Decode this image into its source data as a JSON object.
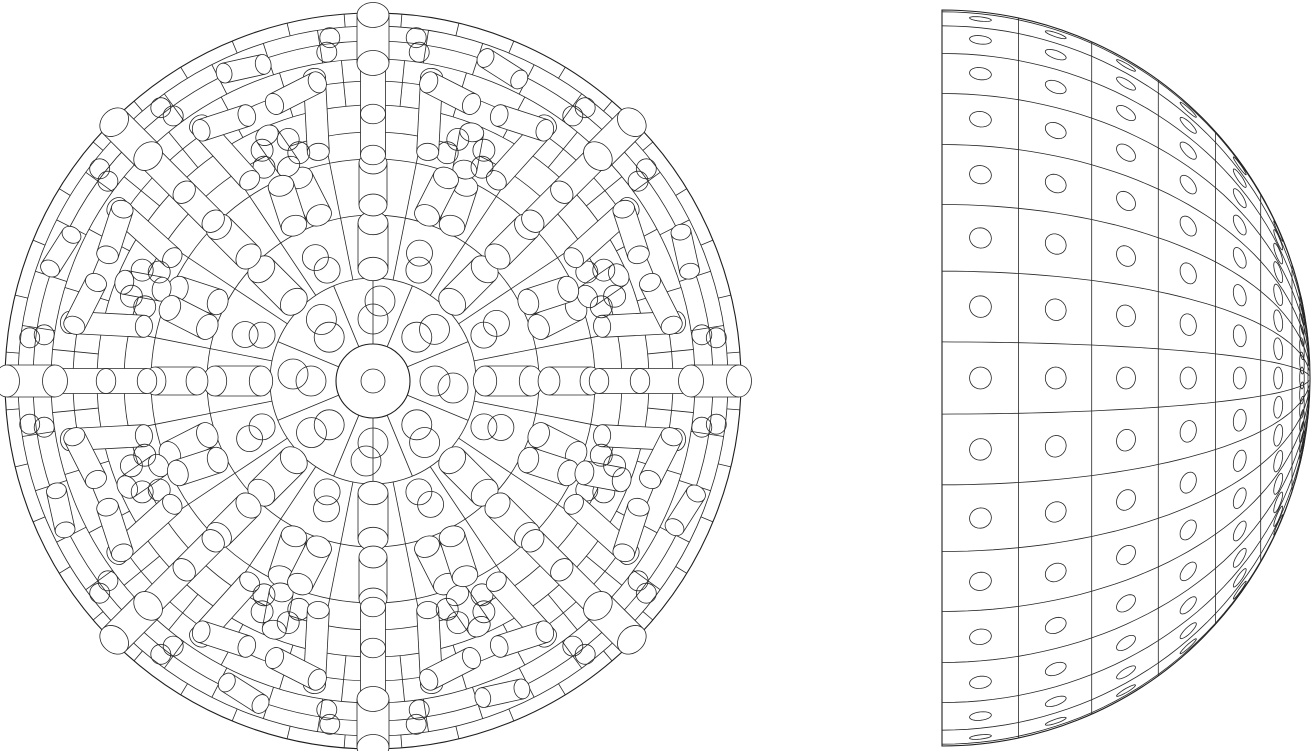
{
  "page": {
    "background_color": "#ffffff",
    "width": 1313,
    "height": 751,
    "title": "Perforated dome two-view technical drawing"
  },
  "drawing": {
    "type": "cad_wireframe",
    "description": "Black-on-white line drawing, two orthographic views of a hemispherical dome assembly: left plan view of concentric panel rings with cylindrical pegs, right side elevation with grid panels each pierced by a round hole",
    "stroke_color": "#262626",
    "stroke_color_outline": "#1f1f1f",
    "stroke_width_detail": 0.8,
    "stroke_width_outline": 1.1,
    "plan_view": {
      "center": [
        373,
        381
      ],
      "outer_radius": 368,
      "hub_hole_radius": 12,
      "hub_disc_radius": 37,
      "ring_circles": [
        12,
        37,
        103,
        166,
        222,
        249,
        276,
        300,
        322,
        340,
        355,
        368
      ],
      "centerline_axis": "vertical",
      "wedge_count": 8,
      "sector_line_sets": [
        {
          "r0": 37,
          "r1": 103,
          "count": 8,
          "offset": 22.5
        },
        {
          "r0": 103,
          "r1": 166,
          "count": 16,
          "offset": 11.25
        },
        {
          "r0": 166,
          "r1": 222,
          "count": 16,
          "offset": 11.25
        },
        {
          "r0": 222,
          "r1": 276,
          "count": 16,
          "offset": 11.25
        },
        {
          "r0": 276,
          "r1": 322,
          "count": 32,
          "offset": 5.625
        },
        {
          "r0": 322,
          "r1": 355,
          "count": 40,
          "offset": 0
        },
        {
          "r0": 355,
          "r1": 368,
          "count": 40,
          "offset": 4.5
        }
      ],
      "pegs_per_wedge": [
        {
          "type": "dc",
          "a": 0,
          "r": [
            62,
            80
          ],
          "cr": 15,
          "tshift": 7
        },
        {
          "type": "cap",
          "a": 0,
          "r0": 112,
          "r1": 158,
          "w": 15,
          "tilt": 0
        },
        {
          "type": "dc",
          "a": 22.5,
          "r": [
            120,
            136
          ],
          "cr": 13,
          "tshift": -6
        },
        {
          "type": "cap",
          "a": 0,
          "r0": 176,
          "r1": 218,
          "w": 14,
          "tilt": 0
        },
        {
          "type": "cap",
          "a": 19,
          "r0": 174,
          "r1": 216,
          "w": 13,
          "tilt": 8
        },
        {
          "type": "cap",
          "a": -19,
          "r0": 174,
          "r1": 216,
          "w": 13,
          "tilt": -8
        },
        {
          "type": "cap",
          "a": 22.5,
          "r0": 230,
          "r1": 268,
          "w": 12,
          "tilt": 12
        },
        {
          "type": "dc",
          "a": 27,
          "r": [
            240,
            256
          ],
          "cr": 11,
          "tshift": 6
        },
        {
          "type": "dc",
          "a": -27,
          "r": [
            240,
            256
          ],
          "cr": 11,
          "tshift": -6
        },
        {
          "type": "cap",
          "a": 12,
          "r0": 235,
          "r1": 310,
          "w": 11,
          "tilt": -9
        },
        {
          "type": "cap",
          "a": -12,
          "r0": 235,
          "r1": 310,
          "w": 11,
          "tilt": 9
        },
        {
          "type": "spoke",
          "a": 0,
          "r0": 226,
          "r1": 324,
          "w": 12.5,
          "mid": 267
        },
        {
          "type": "tan",
          "a": 15,
          "rc": 298,
          "hl": 24,
          "w": 11,
          "tilt": 12
        },
        {
          "type": "tan",
          "a": -15,
          "rc": 298,
          "hl": 24,
          "w": 11,
          "tilt": -12
        },
        {
          "type": "tan",
          "a": 22.5,
          "rc": 338,
          "hl": 20,
          "w": 10,
          "tilt": -10
        },
        {
          "type": "dc",
          "a": 8,
          "r": [
            332,
            346
          ],
          "cr": 10,
          "tshift": 5
        },
        {
          "type": "dc",
          "a": -8,
          "r": [
            332,
            346
          ],
          "cr": 10,
          "tshift": -5
        },
        {
          "type": "cap",
          "a": 0,
          "r0": 318,
          "r1": 366,
          "w": 16,
          "tilt": 0
        }
      ],
      "peg_end_ellipse_ratio": 0.78
    },
    "side_view": {
      "center": [
        942,
        378
      ],
      "radius": 368,
      "flat_edge": "left",
      "latitude_step_deg": 12,
      "latitude_max_deg": 84,
      "meridian_step_deg": 11.25,
      "meridian_offset_deg": 5.625,
      "meridian_count": 16,
      "hole_radius": 11,
      "hole_latitude_centers_deg": [
        6,
        18,
        30,
        42,
        54,
        66,
        78
      ],
      "hole_meridian_centers_deg": [
        11.25,
        22.5,
        33.75,
        45,
        56.25,
        67.5,
        78.75,
        90,
        101.25,
        112.5,
        123.75,
        135,
        146.25,
        157.5,
        168.75
      ]
    }
  }
}
